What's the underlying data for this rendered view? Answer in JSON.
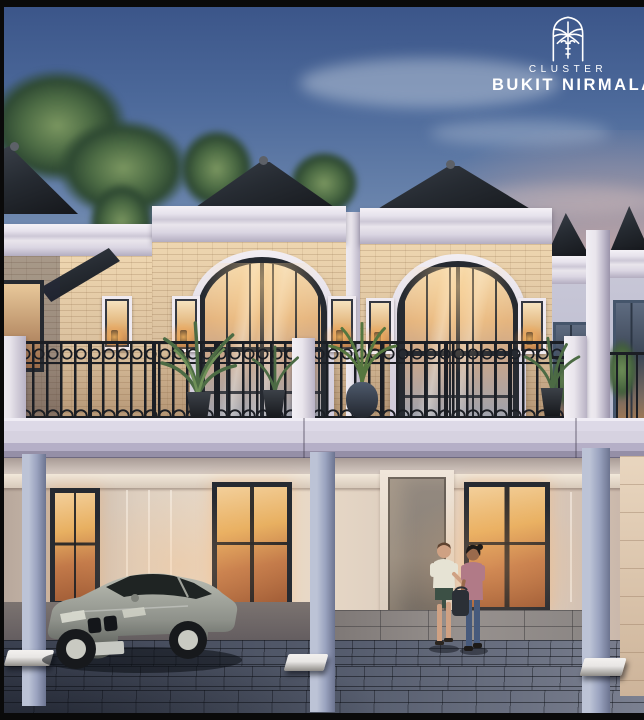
{
  "branding": {
    "cluster_label": "CLUSTER",
    "name": "BUKIT NIRMALA",
    "logo_icon": "palm-tree-arch-icon"
  },
  "palette": {
    "sky-top": "#3a5488",
    "sky-mid": "#6d87ae",
    "sky-low": "#a8abbe",
    "sunset-pink": "#cfa8a2",
    "cloud": "#dfe6ee",
    "foliage-dark": "#2f4a33",
    "foliage-mid": "#4c6b44",
    "foliage-light": "#7a9660",
    "roof-dark": "#15171b",
    "roof-light": "#3a4049",
    "cornice": "#e9e5ec",
    "cornice-shade": "#cdc8d6",
    "brick": "#d9bf9d",
    "brick-light": "#eed6b0",
    "brick-shade": "#b0906f",
    "frame-dark": "#262a31",
    "glass-warm": "#f2dcb6",
    "glass-amber": "#e5b57f",
    "glass-cool": "#98a1b2",
    "railing": "#1b1e24",
    "beam": "#d6d2e0",
    "beam-shade": "#958fa7",
    "carport-ceiling": "#cbbfb8",
    "carport-wall": "#dfd0c0",
    "column-blue": "#9aa3bf",
    "column-light": "#bcc3d6",
    "door-gray": "#8b8279",
    "window-glow": "#e8b061",
    "window-ember": "#a05c36",
    "pave-dark": "#3c4252",
    "pave-mid": "#565d6e",
    "pave-light": "#7b8090",
    "tile-warm": "#97918e",
    "stopper-white": "#e8e6e4",
    "car-body": "#8e918a",
    "car-body-light": "#babdb3",
    "car-body-dark": "#4e524e",
    "car-glass": "#1f2423",
    "wheel-dark": "#17191c",
    "rim-light": "#c9cac2",
    "skin-man": "#cfa183",
    "skin-woman": "#9a6a4c",
    "hair-brown": "#5f4330",
    "hair-dark": "#1d1a18",
    "shirt-man": "#e6e3d4",
    "shorts-man": "#3c5045",
    "top-woman": "#b17a87",
    "jeans-woman": "#475a7c",
    "bag-dark": "#2b2f36",
    "distant-wall": "#b7b9cf",
    "distant-frame": "#45556b",
    "frame-black": "#0a0a0a"
  }
}
